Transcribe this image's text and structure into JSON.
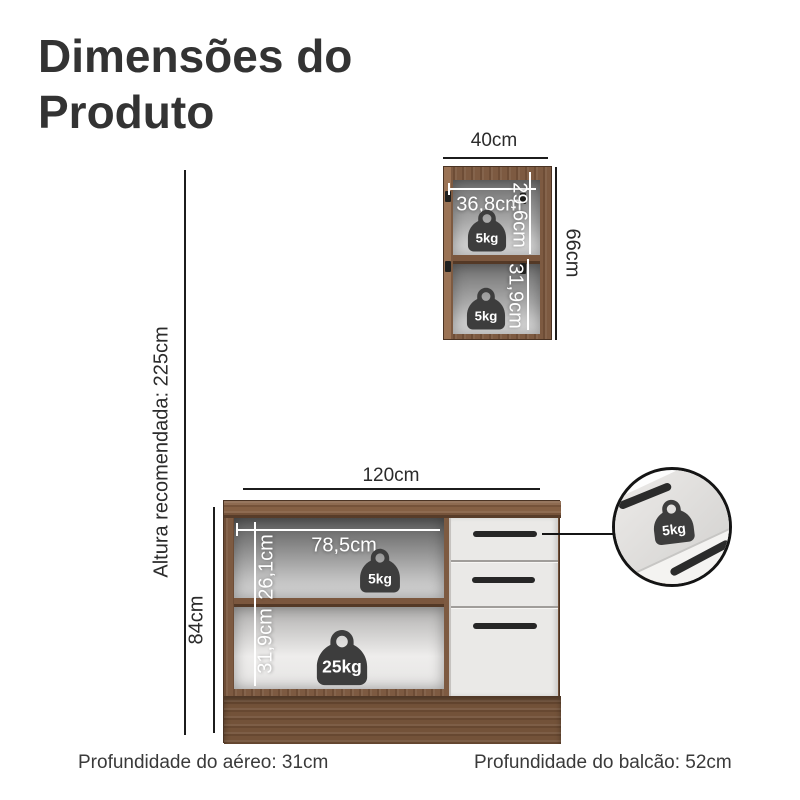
{
  "title": "Dimensões do Produto",
  "annotations": {
    "recommended_height": "Altura recomendada: 225cm",
    "aereo_depth": "Profundidade do aéreo: 31cm",
    "balcao_depth": "Profundidade do balcão: 52cm"
  },
  "upper_cabinet": {
    "width": "40cm",
    "height": "66cm",
    "shelf_top": {
      "inner_width": "36,8cm",
      "inner_height": "29,6cm",
      "max_load": "5kg"
    },
    "shelf_bottom": {
      "inner_height": "31,9cm",
      "max_load": "5kg"
    }
  },
  "base_cabinet": {
    "width": "120cm",
    "height": "84cm",
    "shelf_top": {
      "inner_width": "78,5cm",
      "inner_height": "26,1cm",
      "max_load": "5kg"
    },
    "shelf_bottom": {
      "inner_height": "31,9cm",
      "max_load": "25kg"
    },
    "drawer_detail": {
      "max_load": "5kg"
    }
  },
  "colors": {
    "wood": "#7d5a41",
    "drawer_front": "#eae9e7",
    "weight_badge": "#3d3d3d",
    "dimension_line": "#1c1c1c",
    "title_text": "#333333"
  }
}
